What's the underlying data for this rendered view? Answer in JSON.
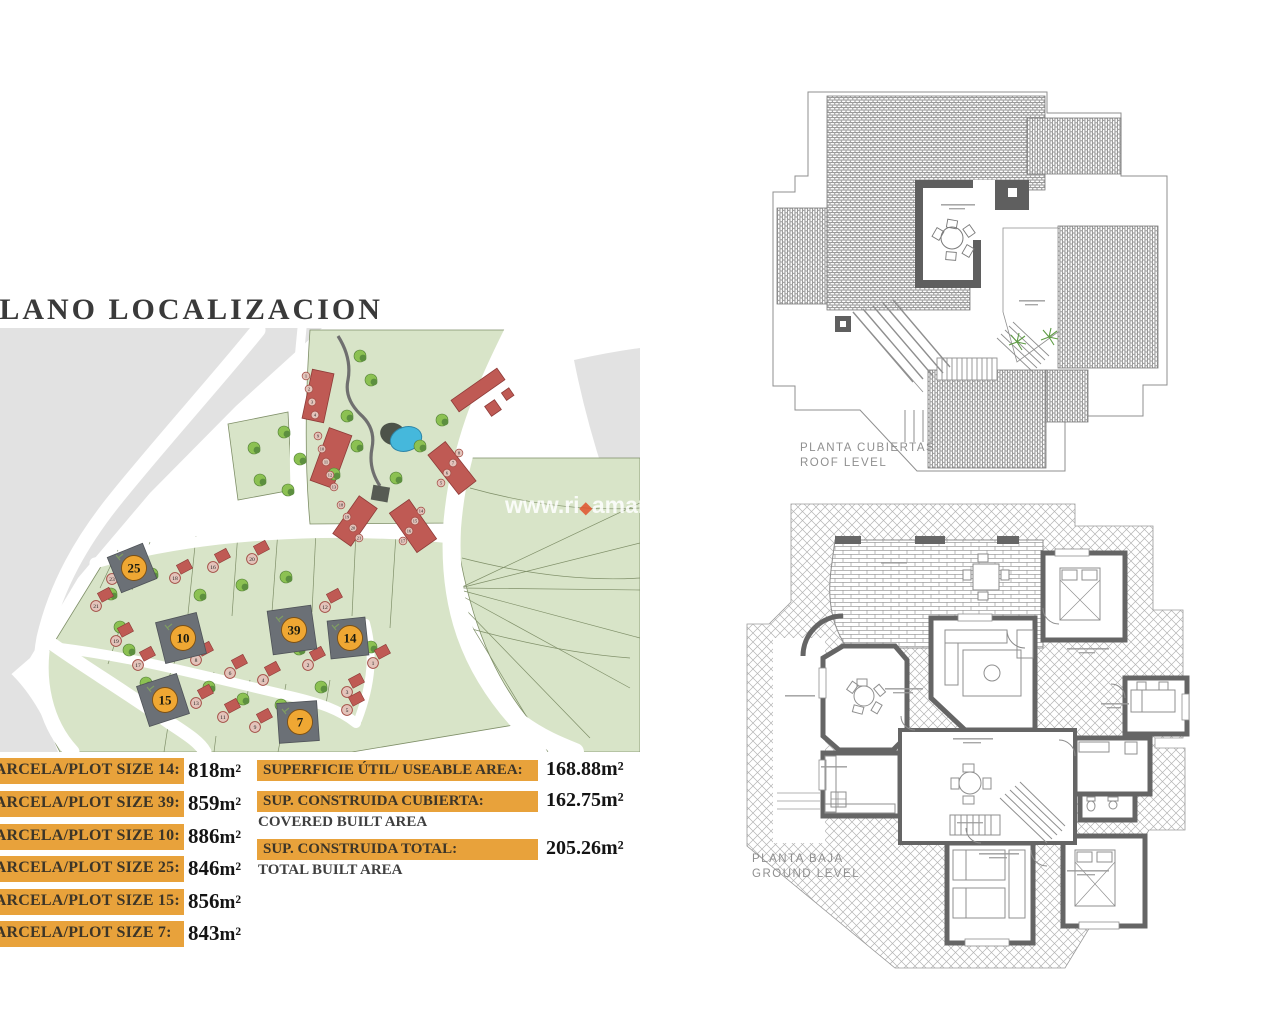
{
  "title": "PLANO LOCALIZACION",
  "plot_table": {
    "rows": [
      {
        "label": "PARCELA/PLOT SIZE 14:",
        "value": "818",
        "unit": "m²"
      },
      {
        "label": "PARCELA/PLOT SIZE 39:",
        "value": "859",
        "unit": "m²"
      },
      {
        "label": "PARCELA/PLOT SIZE 10:",
        "value": "886",
        "unit": "m²"
      },
      {
        "label": "PARCELA/PLOT SIZE 25:",
        "value": "846",
        "unit": "m²"
      },
      {
        "label": "PARCELA/PLOT SIZE 15:",
        "value": "856",
        "unit": "m²"
      },
      {
        "label": "PARCELA/PLOT SIZE 7:",
        "value": "843",
        "unit": "m²"
      }
    ]
  },
  "area_table": {
    "rows": [
      {
        "label": "SUPERFICIE ÚTIL/ USEABLE AREA:",
        "sublabel": "",
        "value": "168.88",
        "unit": "m²"
      },
      {
        "label": "SUP. CONSTRUIDA CUBIERTA:",
        "sublabel": "COVERED BUILT AREA",
        "value": "162.75",
        "unit": "m²"
      },
      {
        "label": "SUP. CONSTRUIDA TOTAL:",
        "sublabel": "TOTAL BUILT AREA",
        "value": "205.26",
        "unit": "m²"
      }
    ]
  },
  "roof_plan": {
    "label_line1": "PLANTA CUBIERTAS",
    "label_line2": "ROOF LEVEL"
  },
  "ground_plan": {
    "label_line1": "PLANTA BAJA",
    "label_line2": "GROUND LEVEL"
  },
  "watermark": {
    "prefix": "www.ri",
    "accent": "◆",
    "suffix": "amar"
  },
  "site_plan": {
    "highlighted_plots": [
      {
        "n": "25",
        "x": 132,
        "y": 240,
        "s": 38,
        "r": -22
      },
      {
        "n": "10",
        "x": 181,
        "y": 310,
        "s": 42,
        "r": -14
      },
      {
        "n": "39",
        "x": 292,
        "y": 302,
        "s": 44,
        "r": -8
      },
      {
        "n": "14",
        "x": 348,
        "y": 310,
        "s": 38,
        "r": -6
      },
      {
        "n": "15",
        "x": 163,
        "y": 372,
        "s": 42,
        "r": -18
      },
      {
        "n": "7",
        "x": 298,
        "y": 394,
        "s": 40,
        "r": -4
      }
    ],
    "small_plots": [
      {
        "n": "23",
        "x": 112,
        "y": 251
      },
      {
        "n": "21",
        "x": 96,
        "y": 278
      },
      {
        "n": "19",
        "x": 116,
        "y": 313
      },
      {
        "n": "17",
        "x": 138,
        "y": 337
      },
      {
        "n": "18",
        "x": 175,
        "y": 250
      },
      {
        "n": "16",
        "x": 213,
        "y": 239
      },
      {
        "n": "20",
        "x": 252,
        "y": 231
      },
      {
        "n": "12",
        "x": 325,
        "y": 279
      },
      {
        "n": "8",
        "x": 196,
        "y": 332
      },
      {
        "n": "6",
        "x": 230,
        "y": 345
      },
      {
        "n": "4",
        "x": 263,
        "y": 352
      },
      {
        "n": "2",
        "x": 308,
        "y": 337
      },
      {
        "n": "13",
        "x": 196,
        "y": 375
      },
      {
        "n": "11",
        "x": 223,
        "y": 389
      },
      {
        "n": "9",
        "x": 255,
        "y": 399
      },
      {
        "n": "5",
        "x": 347,
        "y": 382
      },
      {
        "n": "3",
        "x": 347,
        "y": 364
      },
      {
        "n": "1",
        "x": 373,
        "y": 335
      }
    ],
    "townhouse_markers": [
      {
        "n": "1",
        "x": 306,
        "y": 48
      },
      {
        "n": "2",
        "x": 309,
        "y": 61
      },
      {
        "n": "3",
        "x": 312,
        "y": 74
      },
      {
        "n": "4",
        "x": 315,
        "y": 87
      },
      {
        "n": "9",
        "x": 318,
        "y": 108
      },
      {
        "n": "10",
        "x": 322,
        "y": 121
      },
      {
        "n": "11",
        "x": 326,
        "y": 134
      },
      {
        "n": "12",
        "x": 330,
        "y": 147
      },
      {
        "n": "13",
        "x": 334,
        "y": 159
      },
      {
        "n": "18",
        "x": 341,
        "y": 177
      },
      {
        "n": "19",
        "x": 347,
        "y": 189
      },
      {
        "n": "20",
        "x": 353,
        "y": 200
      },
      {
        "n": "21",
        "x": 359,
        "y": 210
      },
      {
        "n": "14",
        "x": 421,
        "y": 183
      },
      {
        "n": "15",
        "x": 415,
        "y": 193
      },
      {
        "n": "16",
        "x": 409,
        "y": 203
      },
      {
        "n": "17",
        "x": 403,
        "y": 213
      },
      {
        "n": "5",
        "x": 441,
        "y": 155
      },
      {
        "n": "6",
        "x": 447,
        "y": 145
      },
      {
        "n": "7",
        "x": 453,
        "y": 135
      },
      {
        "n": "8",
        "x": 459,
        "y": 125
      }
    ],
    "trees": [
      [
        360,
        28
      ],
      [
        371,
        52
      ],
      [
        347,
        88
      ],
      [
        357,
        118
      ],
      [
        334,
        146
      ],
      [
        396,
        150
      ],
      [
        420,
        118
      ],
      [
        442,
        92
      ],
      [
        254,
        120
      ],
      [
        284,
        104
      ],
      [
        300,
        131
      ],
      [
        260,
        152
      ],
      [
        288,
        162
      ],
      [
        152,
        246
      ],
      [
        200,
        267
      ],
      [
        242,
        257
      ],
      [
        286,
        249
      ],
      [
        120,
        299
      ],
      [
        146,
        355
      ],
      [
        209,
        359
      ],
      [
        243,
        371
      ],
      [
        281,
        377
      ],
      [
        321,
        359
      ],
      [
        299,
        321
      ],
      [
        371,
        319
      ],
      [
        111,
        266
      ],
      [
        129,
        322
      ]
    ],
    "colors": {
      "green": "#d8e4c8",
      "gray": "#e2e2e2",
      "road": "#ffffff",
      "house": "#bf5a54",
      "house_edge": "#8e3b38",
      "tree_light": "#8cc152",
      "tree_dark": "#5c8f3f",
      "pool": "#45b8dc",
      "highlight_plot": "#6b7076",
      "highlight_circle": "#efa733",
      "boundary_line": "#7f8f68",
      "marker_fill": "#e3c3ba",
      "marker_edge": "#a14a42"
    }
  }
}
